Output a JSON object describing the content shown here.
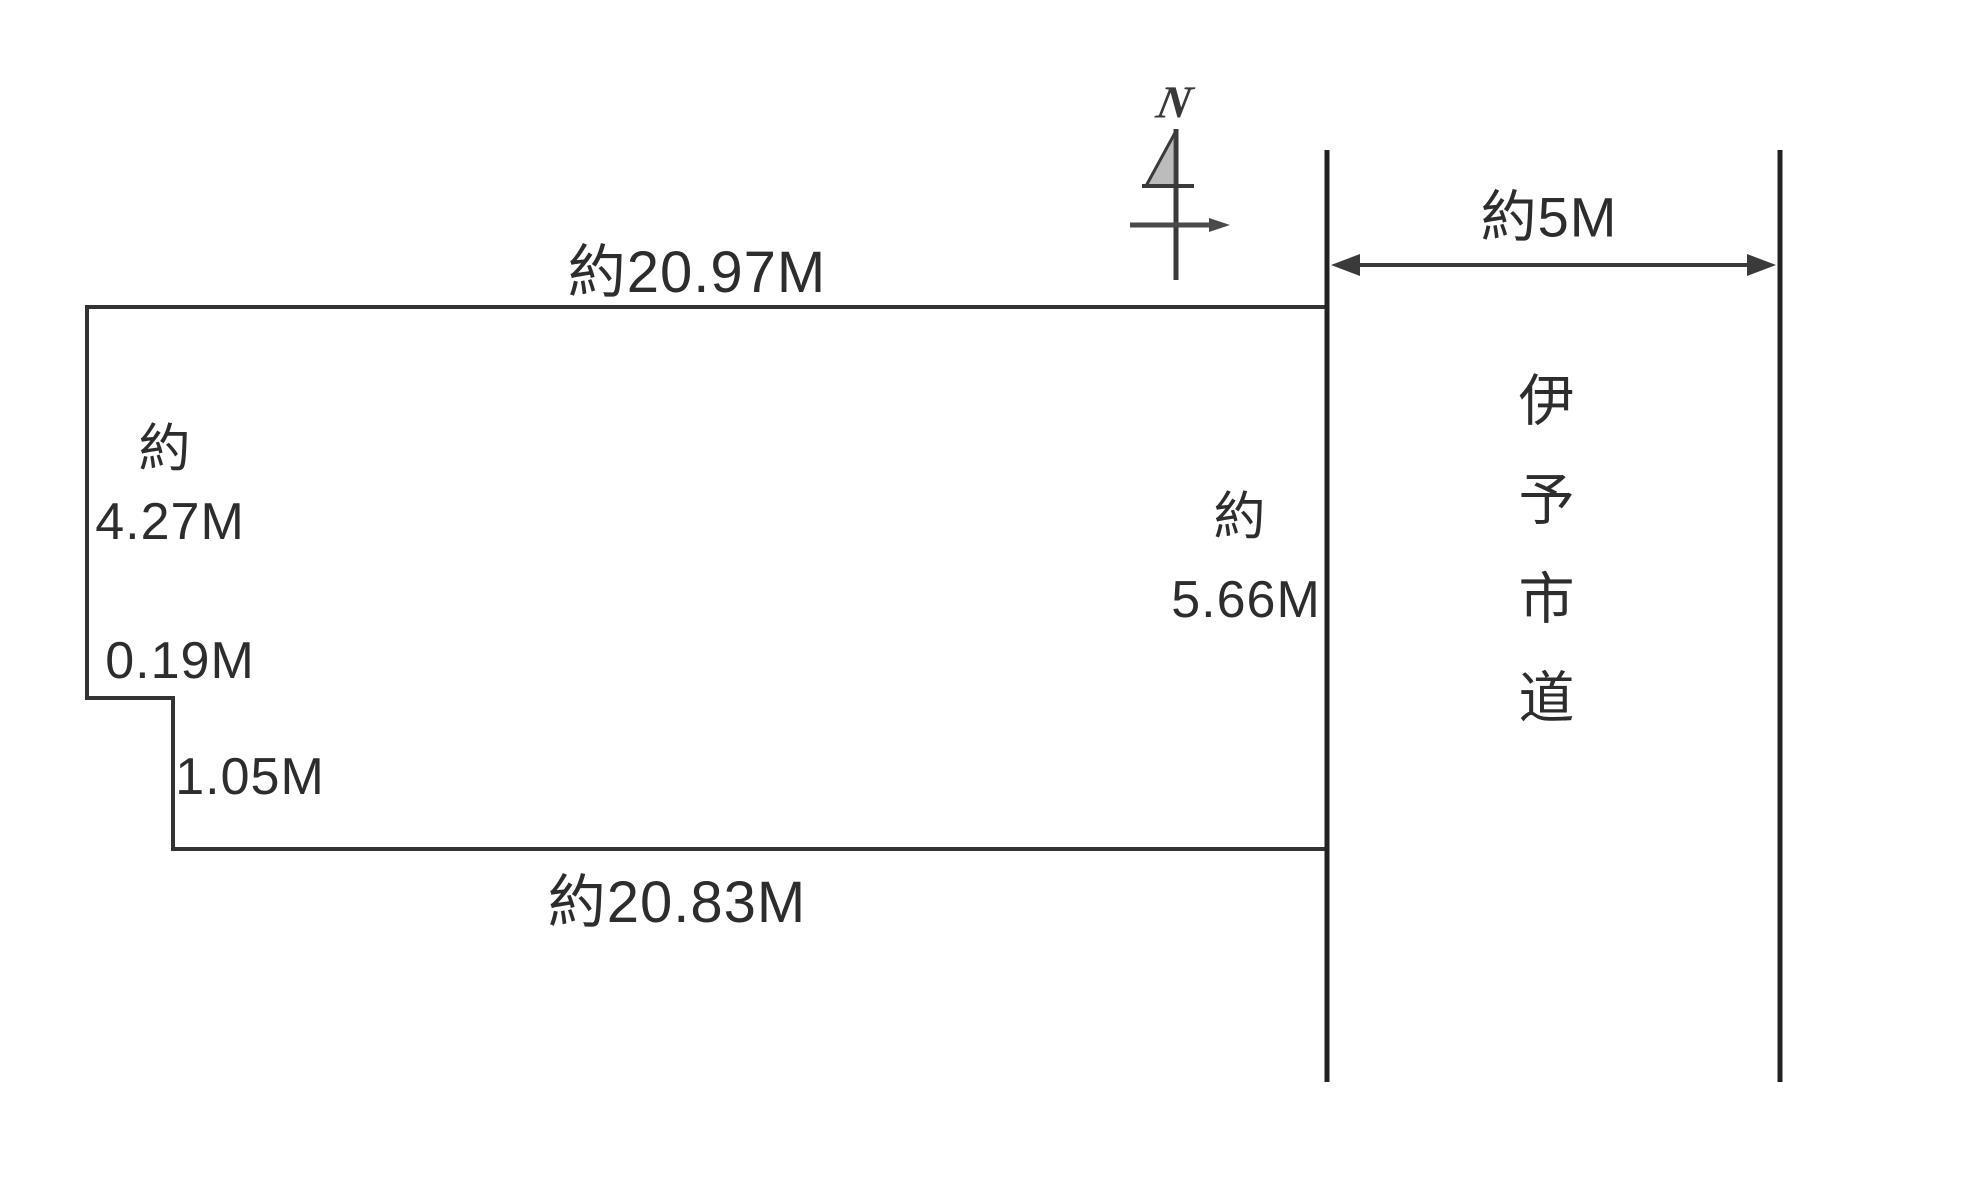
{
  "diagram": {
    "kind": "land-plot-survey-sketch",
    "north_label": "N",
    "plot": {
      "top_edge_label": "約20.97M",
      "bottom_edge_label": "約20.83M",
      "left_edge_approx": "約",
      "left_edge_value": "4.27M",
      "notch_step_label": "0.19M",
      "notch_depth_label": "1.05M",
      "right_edge_approx": "約",
      "right_edge_value": "5.66M"
    },
    "road": {
      "width_label": "約5M",
      "name": "伊予市道"
    },
    "colors": {
      "background": "#ffffff",
      "plot_line": "#333333",
      "road_line": "#222222",
      "text": "#2d2d2d"
    }
  }
}
